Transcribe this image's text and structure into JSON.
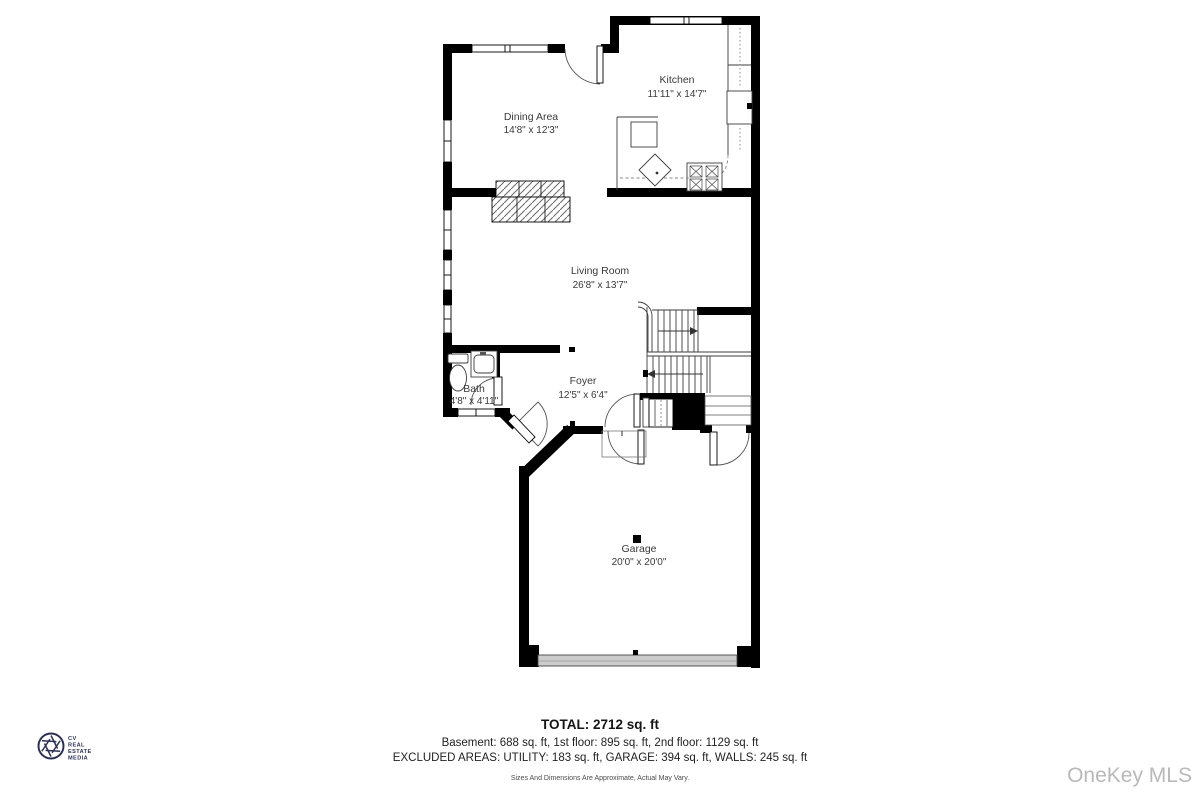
{
  "plan": {
    "rooms": [
      {
        "name": "Kitchen",
        "dims": "11'11\" x 14'7\""
      },
      {
        "name": "Dining Area",
        "dims": "14'8\" x 12'3\""
      },
      {
        "name": "Living Room",
        "dims": "26'8\" x 13'7\""
      },
      {
        "name": "Bath",
        "dims": "4'8\" x 4'11\""
      },
      {
        "name": "Foyer",
        "dims": "12'5\" x 6'4\""
      },
      {
        "name": "Garage",
        "dims": "20'0\" x 20'0\""
      }
    ]
  },
  "footer": {
    "total": "TOTAL: 2712 sq. ft",
    "floors": "Basement: 688 sq. ft, 1st floor: 895 sq. ft, 2nd floor: 1129 sq. ft",
    "excluded": "EXCLUDED AREAS: UTILITY: 183 sq. ft, GARAGE: 394 sq. ft, WALLS: 245 sq. ft",
    "disclaimer": "Sizes And Dimensions Are Approximate, Actual May Vary."
  },
  "branding": {
    "logo_lines": [
      "CV",
      "REAL",
      "ESTATE",
      "MEDIA"
    ],
    "watermark": "OneKey MLS"
  },
  "colors": {
    "wall": "#000000",
    "garage_door": "#cccccc",
    "watermark_gray": "#b9b9b9",
    "logo_navy": "#2b3054",
    "label_gray": "#3a3a3a"
  }
}
